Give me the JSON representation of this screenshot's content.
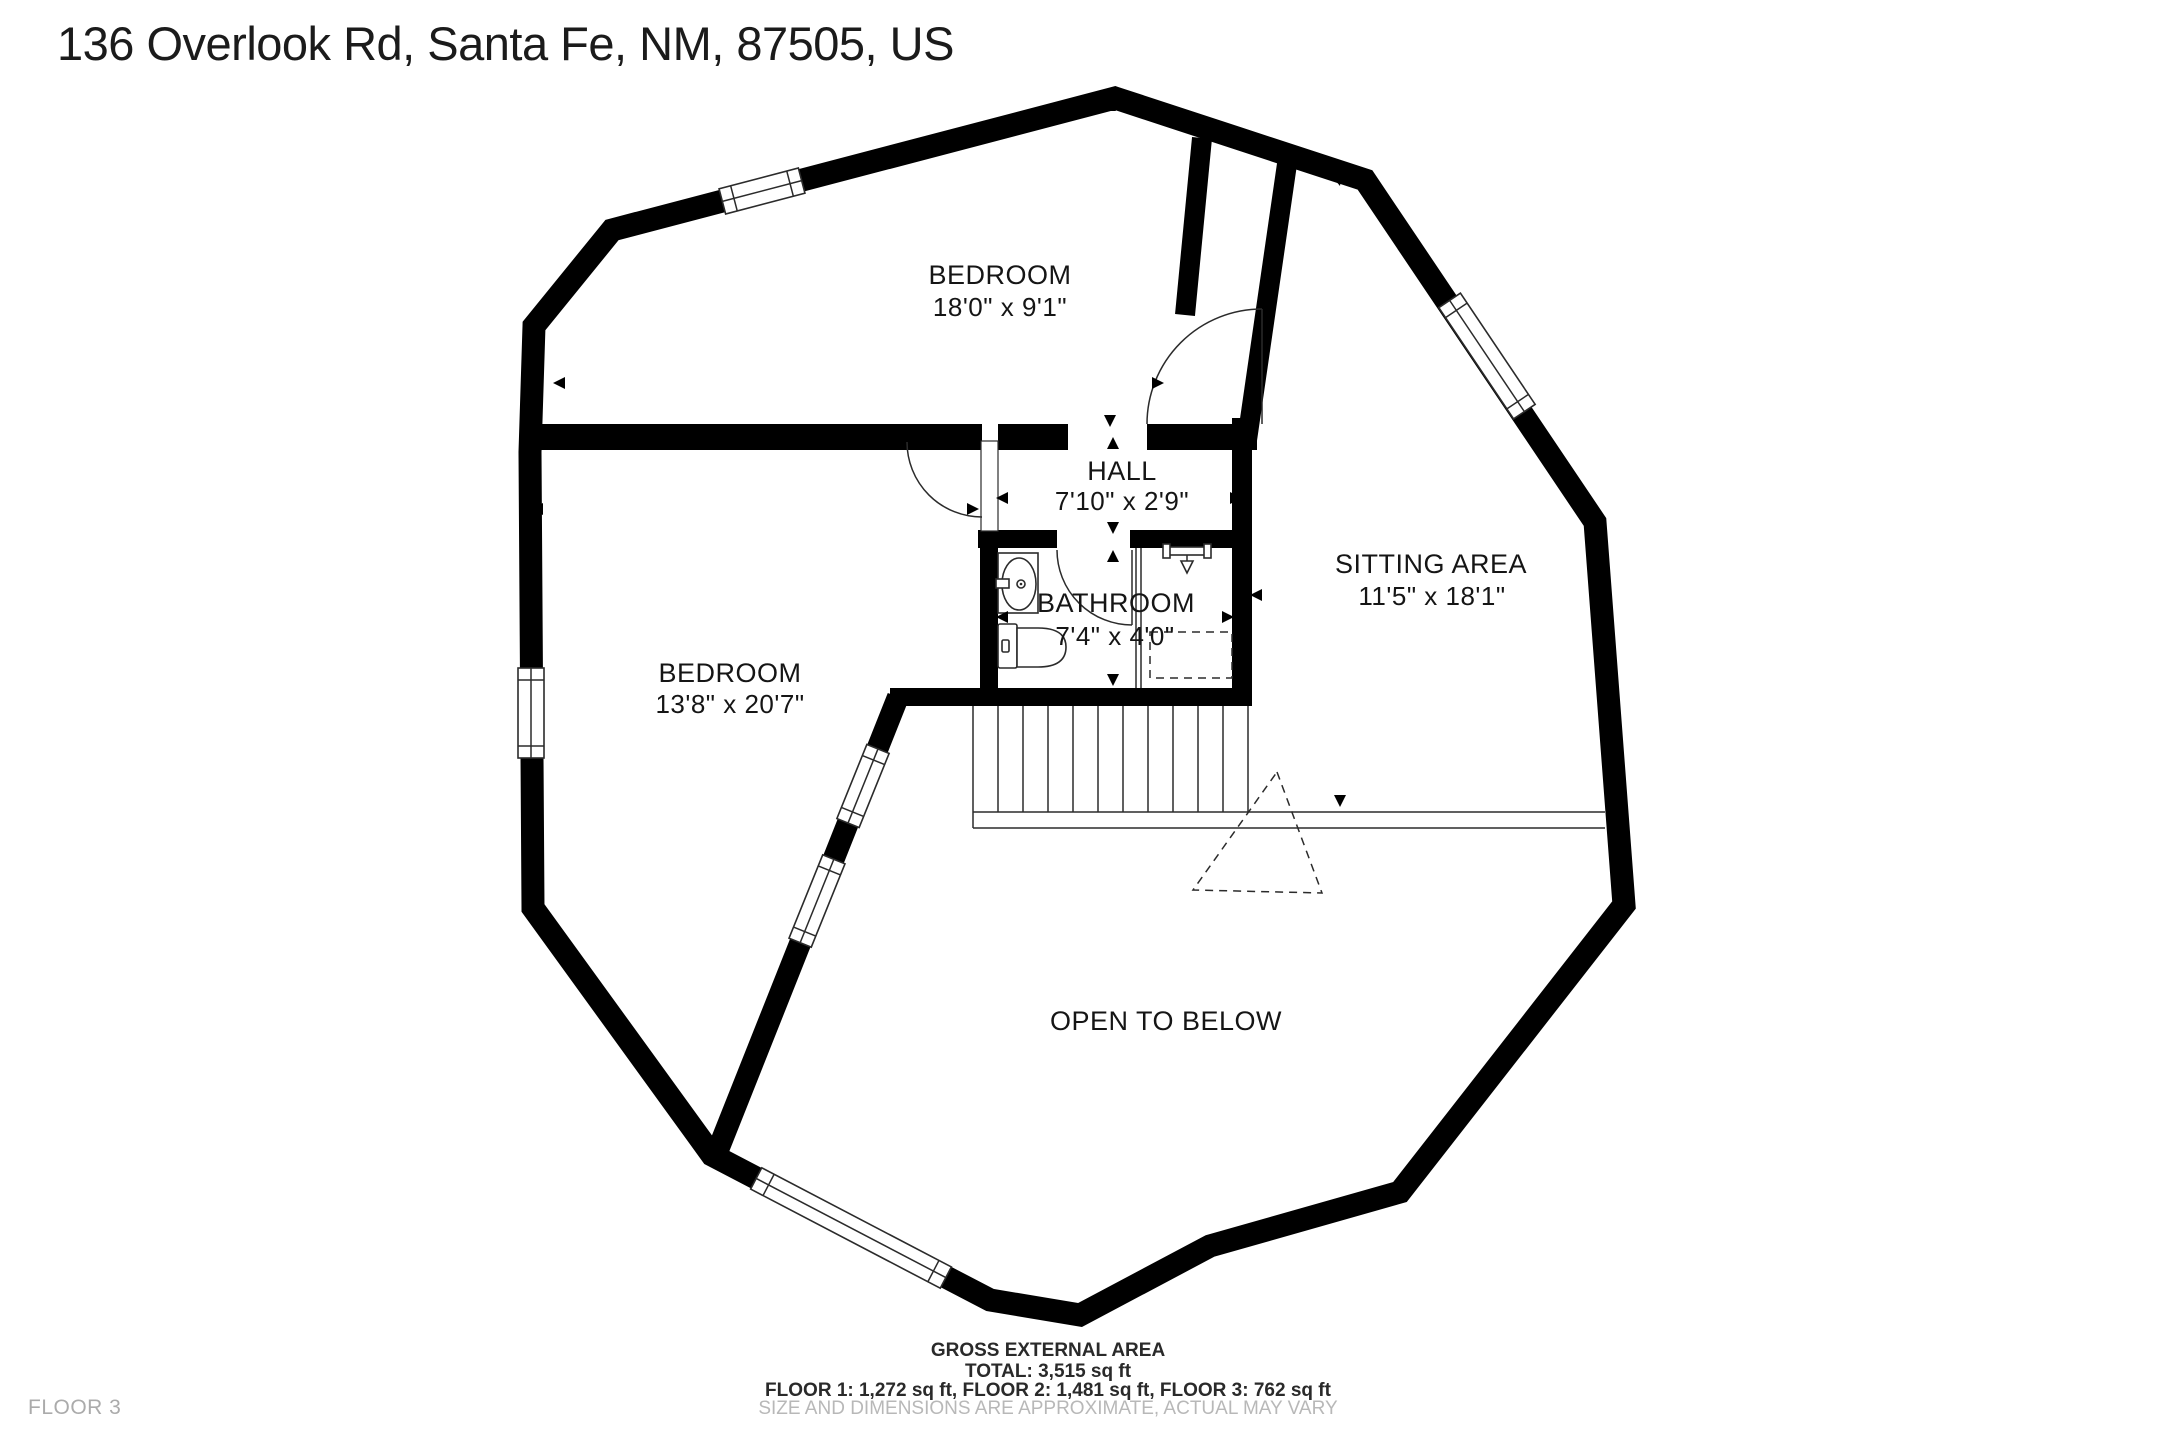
{
  "title": "136 Overlook Rd, Santa Fe, NM, 87505, US",
  "rooms": {
    "bedroom_top": {
      "name": "BEDROOM",
      "dims": "18'0\" x 9'1\""
    },
    "hall": {
      "name": "HALL",
      "dims": "7'10\" x 2'9\""
    },
    "bathroom": {
      "name": "BATHROOM",
      "dims": "7'4\" x 4'0\""
    },
    "sitting_area": {
      "name": "SITTING AREA",
      "dims": "11'5\" x 18'1\""
    },
    "bedroom_left": {
      "name": "BEDROOM",
      "dims": "13'8\" x 20'7\""
    },
    "open_to_below": {
      "name": "OPEN TO BELOW"
    }
  },
  "footer": {
    "area_title": "GROSS EXTERNAL AREA",
    "total": "TOTAL: 3,515 sq ft",
    "floors": "FLOOR 1: 1,272 sq ft, FLOOR 2: 1,481 sq ft, FLOOR 3: 762 sq ft",
    "disclaimer": "SIZE AND DIMENSIONS ARE APPROXIMATE, ACTUAL MAY VARY"
  },
  "floor_label": "FLOOR 3",
  "colors": {
    "wall": "#000000",
    "background": "#ffffff",
    "muted_text": "#b0b0b0",
    "label_text": "#151515"
  }
}
